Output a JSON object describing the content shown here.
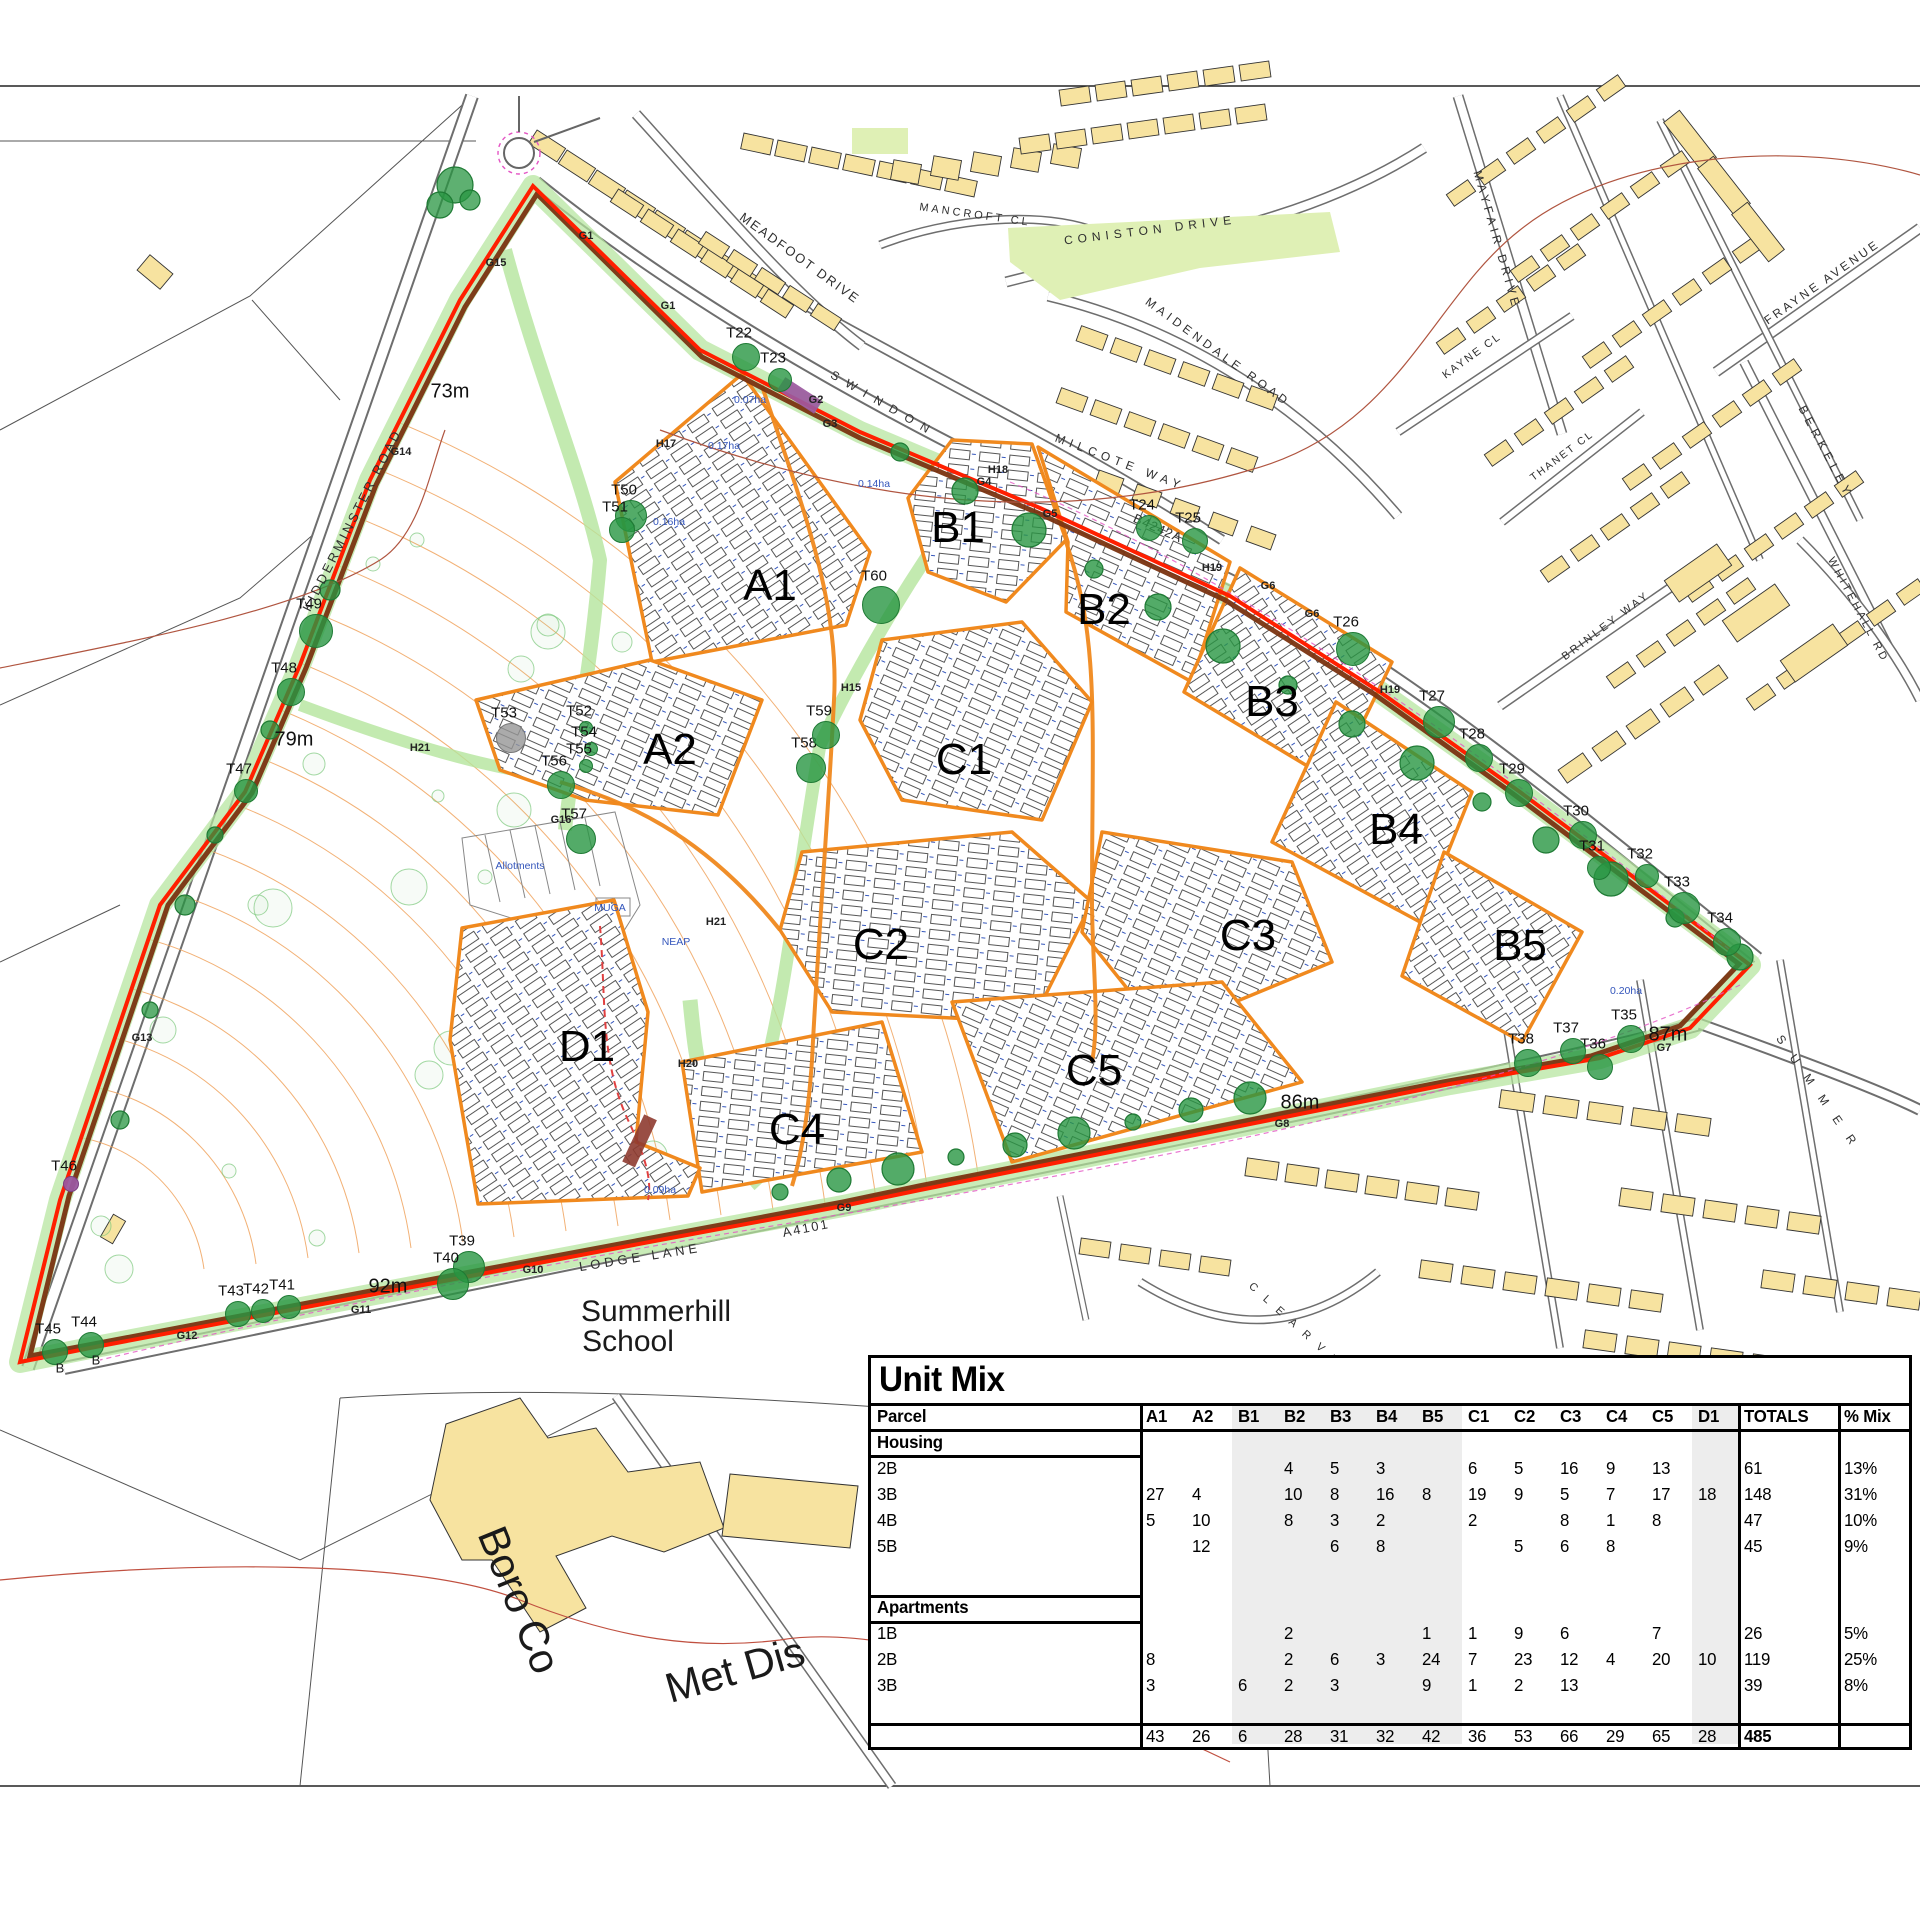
{
  "page_title": "Unit Mix site masterplan",
  "map": {
    "colors": {
      "site_boundary": "#ff1f00",
      "parcel_outline": "#f0891e",
      "hedgerow_line": "#7a3310",
      "tree_green": "#2e9c48",
      "corridor_green": "#b4e59c",
      "existing_building": "#f7e3a0",
      "contour_orange": "#f0a35e",
      "road_casing_grey": "#6e6e6e",
      "admin_boundary_red": "#d05848",
      "magenta_dashed": "#e455c4",
      "purple_feature": "#9b59a0",
      "blue_note": "#3355bb",
      "green_open_space": "#dff0b5"
    },
    "road_labels": [
      {
        "t": "MEADFOOT DRIVE",
        "x": 800,
        "y": 258,
        "r": 36,
        "s": 13,
        "sp": 2
      },
      {
        "t": "MANCROFT CL",
        "x": 975,
        "y": 215,
        "r": 8,
        "s": 11,
        "sp": 3
      },
      {
        "t": "CONISTON DRIVE",
        "x": 1150,
        "y": 230,
        "r": -7,
        "s": 12,
        "sp": 5
      },
      {
        "t": "MAIDENDALE ROAD",
        "x": 1218,
        "y": 352,
        "r": 36,
        "s": 12,
        "sp": 4
      },
      {
        "t": "MILCOTE WAY",
        "x": 1120,
        "y": 462,
        "r": 21,
        "s": 12,
        "sp": 5
      },
      {
        "t": "SWINDON",
        "x": 884,
        "y": 404,
        "r": 30,
        "s": 12,
        "sp": 9
      },
      {
        "t": "MAYFAIR DRIVE",
        "x": 1497,
        "y": 240,
        "r": 74,
        "s": 12,
        "sp": 4
      },
      {
        "t": "KAYNE CL",
        "x": 1472,
        "y": 356,
        "r": -36,
        "s": 11,
        "sp": 2
      },
      {
        "t": "THANET CL",
        "x": 1562,
        "y": 456,
        "r": -37,
        "s": 10.5,
        "sp": 2
      },
      {
        "t": "FRAYNE AVENUE",
        "x": 1822,
        "y": 282,
        "r": -35,
        "s": 12,
        "sp": 3
      },
      {
        "t": "BERKELEY",
        "x": 1826,
        "y": 452,
        "r": 62,
        "s": 12,
        "sp": 5
      },
      {
        "t": "WHITEHALL RD",
        "x": 1858,
        "y": 610,
        "r": 62,
        "s": 11,
        "sp": 3
      },
      {
        "t": "BRINLEY WAY",
        "x": 1606,
        "y": 626,
        "r": -37,
        "s": 11,
        "sp": 3
      },
      {
        "t": "KIDDERMINSTER ROAD",
        "x": 352,
        "y": 520,
        "r": -63,
        "s": 13,
        "sp": 3
      },
      {
        "t": "LODGE LANE",
        "x": 640,
        "y": 1257,
        "r": -9,
        "s": 13,
        "sp": 4
      },
      {
        "t": "A4101",
        "x": 806,
        "y": 1228,
        "r": -11,
        "s": 13,
        "sp": 2
      },
      {
        "t": "B4242A",
        "x": 1158,
        "y": 528,
        "r": 24,
        "s": 13,
        "sp": 1
      },
      {
        "t": "S U M M E R",
        "x": 1818,
        "y": 1092,
        "r": 55,
        "s": 12,
        "sp": 6
      },
      {
        "t": "C L E A R  V W",
        "x": 1296,
        "y": 1326,
        "r": 42,
        "s": 11,
        "sp": 4
      }
    ],
    "parcel_labels": [
      {
        "t": "A1",
        "x": 770,
        "y": 586
      },
      {
        "t": "A2",
        "x": 670,
        "y": 750
      },
      {
        "t": "B1",
        "x": 958,
        "y": 528
      },
      {
        "t": "B2",
        "x": 1104,
        "y": 610
      },
      {
        "t": "B3",
        "x": 1272,
        "y": 702
      },
      {
        "t": "B4",
        "x": 1396,
        "y": 830
      },
      {
        "t": "B5",
        "x": 1520,
        "y": 946
      },
      {
        "t": "C1",
        "x": 964,
        "y": 760
      },
      {
        "t": "C2",
        "x": 881,
        "y": 945
      },
      {
        "t": "C3",
        "x": 1248,
        "y": 936
      },
      {
        "t": "C4",
        "x": 797,
        "y": 1130
      },
      {
        "t": "C5",
        "x": 1094,
        "y": 1071
      },
      {
        "t": "D1",
        "x": 587,
        "y": 1047
      }
    ],
    "trees": [
      {
        "t": "T22",
        "x": 745,
        "y": 356,
        "rr": 13
      },
      {
        "t": "T23",
        "x": 779,
        "y": 379,
        "rr": 11
      },
      {
        "t": "T24",
        "x": 1148,
        "y": 527,
        "rr": 12
      },
      {
        "t": "T25",
        "x": 1194,
        "y": 540,
        "rr": 12
      },
      {
        "t": "T26",
        "x": 1352,
        "y": 648,
        "rr": 16
      },
      {
        "t": "T27",
        "x": 1438,
        "y": 721,
        "rr": 15
      },
      {
        "t": "T28",
        "x": 1478,
        "y": 757,
        "rr": 13
      },
      {
        "t": "T29",
        "x": 1518,
        "y": 792,
        "rr": 13
      },
      {
        "t": "T30",
        "x": 1582,
        "y": 834,
        "rr": 13
      },
      {
        "t": "T31",
        "x": 1598,
        "y": 867,
        "rr": 11
      },
      {
        "t": "T32",
        "x": 1646,
        "y": 875,
        "rr": 11
      },
      {
        "t": "T33",
        "x": 1683,
        "y": 907,
        "rr": 15
      },
      {
        "t": "T34",
        "x": 1726,
        "y": 941,
        "rr": 13
      },
      {
        "t": "T35",
        "x": 1630,
        "y": 1038,
        "rr": 13
      },
      {
        "t": "T36",
        "x": 1599,
        "y": 1066,
        "rr": 12
      },
      {
        "t": "T37",
        "x": 1572,
        "y": 1050,
        "rr": 12
      },
      {
        "t": "T38",
        "x": 1527,
        "y": 1062,
        "rr": 13
      },
      {
        "t": "T39",
        "x": 468,
        "y": 1266,
        "rr": 15
      },
      {
        "t": "T40",
        "x": 452,
        "y": 1283,
        "rr": 15
      },
      {
        "t": "T41",
        "x": 288,
        "y": 1306,
        "rr": 11
      },
      {
        "t": "T42",
        "x": 262,
        "y": 1310,
        "rr": 11
      },
      {
        "t": "T43",
        "x": 237,
        "y": 1313,
        "rr": 12
      },
      {
        "t": "T44",
        "x": 90,
        "y": 1344,
        "rr": 12
      },
      {
        "t": "T45",
        "x": 54,
        "y": 1351,
        "rr": 12
      },
      {
        "t": "T46",
        "x": 70,
        "y": 1183,
        "rr": 7,
        "k": "purple"
      },
      {
        "t": "T47",
        "x": 245,
        "y": 790,
        "rr": 11
      },
      {
        "t": "T48",
        "x": 290,
        "y": 691,
        "rr": 13
      },
      {
        "t": "T49",
        "x": 315,
        "y": 630,
        "rr": 16
      },
      {
        "t": "T50",
        "x": 630,
        "y": 515,
        "rr": 15
      },
      {
        "t": "T51",
        "x": 621,
        "y": 529,
        "rr": 12
      },
      {
        "t": "T52",
        "x": 585,
        "y": 727,
        "rr": 6
      },
      {
        "t": "T53",
        "x": 510,
        "y": 737,
        "rr": 14,
        "k": "gray"
      },
      {
        "t": "T54",
        "x": 590,
        "y": 748,
        "rr": 6
      },
      {
        "t": "T55",
        "x": 585,
        "y": 765,
        "rr": 6
      },
      {
        "t": "T56",
        "x": 560,
        "y": 784,
        "rr": 13
      },
      {
        "t": "T57",
        "x": 580,
        "y": 838,
        "rr": 14
      },
      {
        "t": "T58",
        "x": 810,
        "y": 767,
        "rr": 14
      },
      {
        "t": "T59",
        "x": 825,
        "y": 734,
        "rr": 13
      },
      {
        "t": "T60",
        "x": 880,
        "y": 604,
        "rr": 18
      }
    ],
    "group_labels": [
      {
        "t": "G1",
        "x": 586,
        "y": 236
      },
      {
        "t": "G1",
        "x": 668,
        "y": 306
      },
      {
        "t": "G2",
        "x": 816,
        "y": 400
      },
      {
        "t": "G3",
        "x": 830,
        "y": 424
      },
      {
        "t": "G4",
        "x": 984,
        "y": 482
      },
      {
        "t": "G5",
        "x": 1050,
        "y": 514
      },
      {
        "t": "G6",
        "x": 1268,
        "y": 586
      },
      {
        "t": "G6",
        "x": 1312,
        "y": 614
      },
      {
        "t": "G7",
        "x": 1664,
        "y": 1048
      },
      {
        "t": "G8",
        "x": 1282,
        "y": 1124
      },
      {
        "t": "G9",
        "x": 844,
        "y": 1208
      },
      {
        "t": "G10",
        "x": 533,
        "y": 1270
      },
      {
        "t": "G11",
        "x": 361,
        "y": 1310
      },
      {
        "t": "G12",
        "x": 187,
        "y": 1336
      },
      {
        "t": "G13",
        "x": 142,
        "y": 1038
      },
      {
        "t": "G14",
        "x": 401,
        "y": 452
      },
      {
        "t": "G15",
        "x": 496,
        "y": 263
      },
      {
        "t": "G16",
        "x": 561,
        "y": 820
      },
      {
        "t": "H15",
        "x": 851,
        "y": 688
      },
      {
        "t": "H17",
        "x": 666,
        "y": 444
      },
      {
        "t": "H18",
        "x": 998,
        "y": 470
      },
      {
        "t": "H19",
        "x": 1212,
        "y": 568
      },
      {
        "t": "H19",
        "x": 1390,
        "y": 690
      },
      {
        "t": "H20",
        "x": 688,
        "y": 1064
      },
      {
        "t": "H21",
        "x": 420,
        "y": 748
      },
      {
        "t": "H21",
        "x": 716,
        "y": 922
      }
    ],
    "measurement_labels": [
      {
        "t": "73m",
        "x": 450,
        "y": 392
      },
      {
        "t": "79m",
        "x": 294,
        "y": 740
      },
      {
        "t": "92m",
        "x": 388,
        "y": 1287
      },
      {
        "t": "87m",
        "x": 1668,
        "y": 1035
      },
      {
        "t": "86m",
        "x": 1300,
        "y": 1103
      }
    ],
    "blue_labels": [
      {
        "t": "0.07ha",
        "x": 750,
        "y": 400
      },
      {
        "t": "0.17ha",
        "x": 724,
        "y": 446
      },
      {
        "t": "0.14ha",
        "x": 874,
        "y": 484
      },
      {
        "t": "0.16ha",
        "x": 669,
        "y": 522
      },
      {
        "t": "0.20ha",
        "x": 1626,
        "y": 991
      },
      {
        "t": "0.09ha",
        "x": 660,
        "y": 1190
      },
      {
        "t": "Allotments",
        "x": 520,
        "y": 866
      },
      {
        "t": "MUGA",
        "x": 610,
        "y": 908
      },
      {
        "t": "NEAP",
        "x": 676,
        "y": 942
      }
    ],
    "big_labels": [
      {
        "t": "Summerhill",
        "x": 656,
        "y": 1312,
        "s": 30,
        "r": 0
      },
      {
        "t": "School",
        "x": 628,
        "y": 1342,
        "s": 30,
        "r": 0
      },
      {
        "t": "Boro Co",
        "x": 519,
        "y": 1600,
        "s": 42,
        "r": 68
      },
      {
        "t": "Met Dis",
        "x": 735,
        "y": 1670,
        "s": 42,
        "r": -16
      },
      {
        "t": "B",
        "x": 96,
        "y": 1360,
        "s": 13,
        "r": 0
      },
      {
        "t": "B",
        "x": 60,
        "y": 1368,
        "s": 13,
        "r": 0
      }
    ]
  },
  "table": {
    "title": "Unit Mix",
    "columns": [
      "Parcel",
      "A1",
      "A2",
      "B1",
      "B2",
      "B3",
      "B4",
      "B5",
      "C1",
      "C2",
      "C3",
      "C4",
      "C5",
      "D1",
      "TOTALS",
      "% Mix"
    ],
    "sections": [
      {
        "header": "Housing",
        "rows": [
          {
            "label": "2B",
            "values": [
              "",
              "",
              "",
              "4",
              "5",
              "3",
              "",
              "6",
              "5",
              "16",
              "9",
              "13",
              ""
            ],
            "total": "61",
            "mix": "13%"
          },
          {
            "label": "3B",
            "values": [
              "27",
              "4",
              "",
              "10",
              "8",
              "16",
              "8",
              "19",
              "9",
              "5",
              "7",
              "17",
              "18"
            ],
            "total": "148",
            "mix": "31%"
          },
          {
            "label": "4B",
            "values": [
              "5",
              "10",
              "",
              "8",
              "3",
              "2",
              "",
              "2",
              "",
              "8",
              "1",
              "8",
              ""
            ],
            "total": "47",
            "mix": "10%"
          },
          {
            "label": "5B",
            "values": [
              "",
              "12",
              "",
              "",
              "6",
              "8",
              "",
              "",
              "5",
              "6",
              "8",
              "",
              ""
            ],
            "total": "45",
            "mix": "9%"
          }
        ]
      },
      {
        "header": "Apartments",
        "rows": [
          {
            "label": "1B",
            "values": [
              "",
              "",
              "",
              "2",
              "",
              "",
              "1",
              "1",
              "9",
              "6",
              "",
              "7",
              ""
            ],
            "total": "26",
            "mix": "5%"
          },
          {
            "label": "2B",
            "values": [
              "8",
              "",
              "",
              "2",
              "6",
              "3",
              "24",
              "7",
              "23",
              "12",
              "4",
              "20",
              "10"
            ],
            "total": "119",
            "mix": "25%"
          },
          {
            "label": "3B",
            "values": [
              "3",
              "",
              "6",
              "2",
              "3",
              "",
              "9",
              "1",
              "2",
              "13",
              "",
              "",
              ""
            ],
            "total": "39",
            "mix": "8%"
          }
        ]
      }
    ],
    "totals_row": {
      "values": [
        "43",
        "26",
        "6",
        "28",
        "31",
        "32",
        "42",
        "36",
        "53",
        "66",
        "29",
        "65",
        "28"
      ],
      "total": "485",
      "mix": ""
    }
  }
}
